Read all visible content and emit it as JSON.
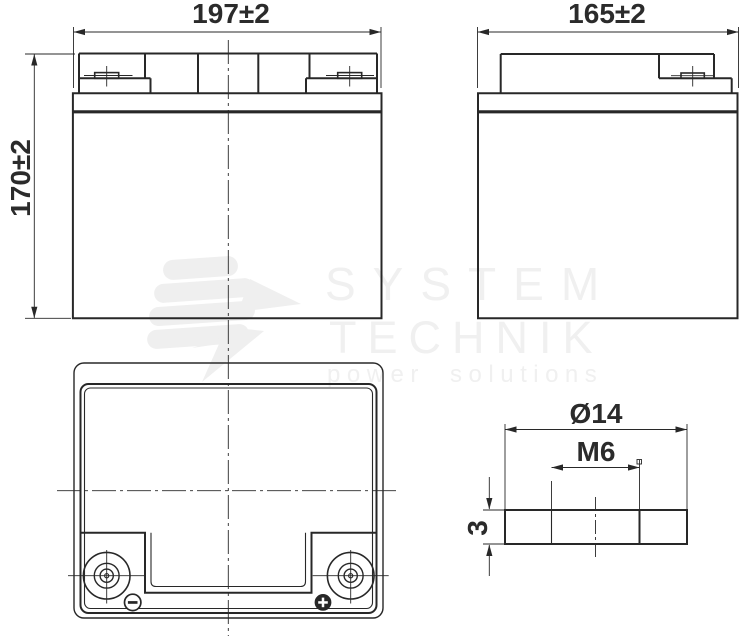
{
  "views": {
    "front": {
      "width_dim": "197±2",
      "height_dim": "170±2"
    },
    "side": {
      "width_dim": "165±2"
    },
    "terminal_detail": {
      "diameter_dim": "Ø14",
      "thread_dim": "M6",
      "thickness_dim": "3"
    }
  },
  "watermark": {
    "brand_line1": "SYSTEM",
    "brand_line2": "TECHNIK",
    "tagline": "power solutions"
  },
  "icons": {
    "negative_terminal": "minus-in-circle-icon",
    "positive_terminal": "plus-in-filled-circle-icon",
    "brand_logo": "lightning-bars-logo-icon"
  },
  "colors": {
    "line": "#282828",
    "dimension_text": "#2b2b2b",
    "watermark": "#f0f0f0",
    "background": "#ffffff"
  }
}
